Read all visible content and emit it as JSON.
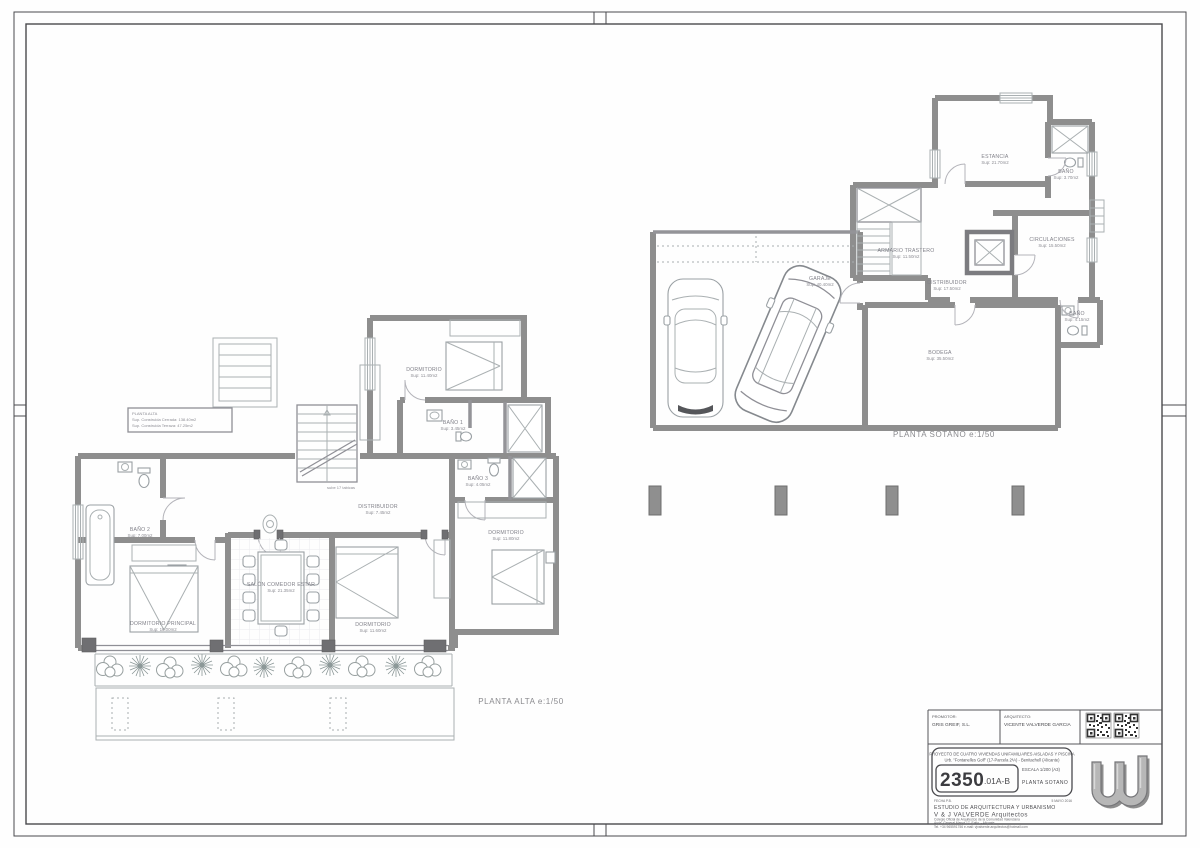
{
  "page": {
    "type": "architectural plan sheet",
    "wall_color": "#8e8e8e",
    "line_color": "#aab0b2",
    "label_color": "#82828a"
  },
  "plans": {
    "alta": {
      "caption": "PLANTA ALTA  e:1/50",
      "stair_note": "sube 17 tabicas",
      "note_box": {
        "line1": "PLANTA ALTA",
        "line2": "Sup. Construida Cerrada: 138.40m2",
        "line3": "Sup. Construida Terraza: 47.25m2"
      },
      "rooms": [
        {
          "name": "DORMITORIO",
          "sup": "Sup: 11.40m2"
        },
        {
          "name": "BAÑO 1",
          "sup": "Sup: 3.45m2"
        },
        {
          "name": "DISTRIBUIDOR",
          "sup": "Sup: 7.45m2"
        },
        {
          "name": "BAÑO 2",
          "sup": "Sup: 7.00m2"
        },
        {
          "name": "DORMITORIO PRINCIPAL",
          "sup": "Sup: 16.00m2"
        },
        {
          "name": "SALÓN COMEDOR ESTAR",
          "sup": "Sup: 21.35m2"
        },
        {
          "name": "DORMITORIO",
          "sup": "Sup: 11.60m2"
        },
        {
          "name": "DORMITORIO",
          "sup": "Sup: 11.80m2"
        },
        {
          "name": "BAÑO 3",
          "sup": "Sup: 4.05m2"
        }
      ]
    },
    "sotano": {
      "caption": "PLANTA SOTANO  e:1/50",
      "rooms": [
        {
          "name": "GARAJE",
          "sup": "Sup: 40.40m2"
        },
        {
          "name": "ESTANCIA",
          "sup": "Sup: 21.70m2"
        },
        {
          "name": "BAÑO",
          "sup": "Sup: 3.70m2"
        },
        {
          "name": "ARMARIO TRASTERO",
          "sup": "Sup: 11.50m2"
        },
        {
          "name": "CIRCULACIONES",
          "sup": "Sup: 15.50m2"
        },
        {
          "name": "DISTRIBUIDOR",
          "sup": "Sup: 17.50m2"
        },
        {
          "name": "BODEGA",
          "sup": "Sup: 35.50m2"
        },
        {
          "name": "BAÑO",
          "sup": "Sup: 4.15m2"
        }
      ]
    }
  },
  "title_block": {
    "promoter_label": "PROMOTOR:",
    "promoter": "GRIS GREIF, S.L.",
    "architect_label": "ARQUITECTO:",
    "architect": "VICENTE VALVERDE GARCIA",
    "project_line1": "PROYECTO DE CUATRO VIVIENDAS UNIFAMILIARES AISLADAS Y PISCINA",
    "project_line2": "Urb. \"Fontanelles Golf\" (17-Parcela 2ªA) - Benitachell (Alicante)",
    "number_big": "2350",
    "number_suffix": ".01A-B",
    "scale": "ESCALA  1/200 (A3)",
    "sheet": "PLANTA SOTANO",
    "date_label": "FECHA P.B.",
    "date": "5 MAYO 2016",
    "studio_line1": "ESTUDIO DE ARQUITECTURA Y URBANISMO",
    "studio_line2": "V & J VALVERDE  Arquitectos",
    "small_line1": "Colegio Oficial de Arquitectos de la Comunidad Valenciana",
    "small_line2": "Avda. General Marvá 17, Entlo. - Alicante",
    "small_line3": "Tel. +34 965591756   e-mail: vjvalverde.arquitectos@hotmail.com"
  }
}
